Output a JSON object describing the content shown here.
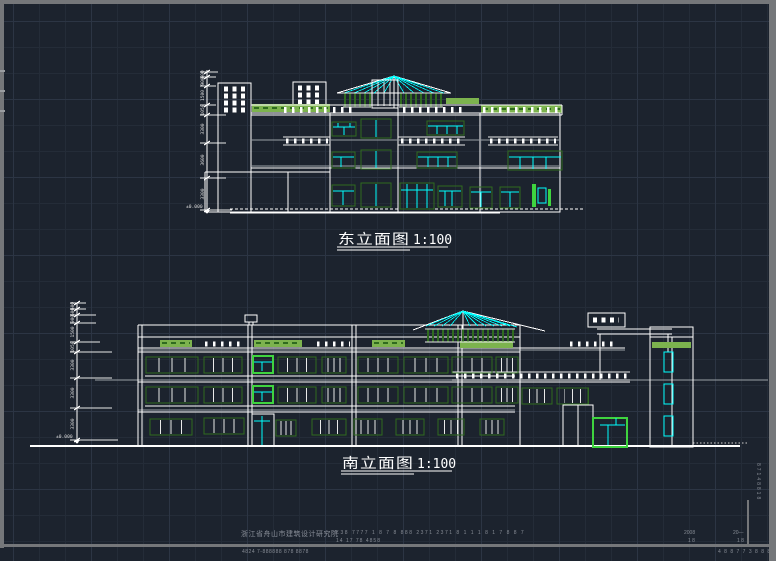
{
  "canvas": {
    "background": "#1c232e",
    "grid_minor": "#242c38",
    "grid_major": "#2c3544",
    "frame_color": "#75777a"
  },
  "palette": {
    "line_white": "#ffffff",
    "cyan": "#00ffff",
    "green_light": "#7cb34e",
    "green_dark": "#2f6b1f",
    "green_bright": "#3fd43f",
    "gray_line": "#9aa0a6",
    "faint_text": "#868b94"
  },
  "east_elevation": {
    "title": "东立面图",
    "scale": "1:100",
    "datum": "±0.000",
    "dims": [
      "600",
      "900",
      "1500",
      "1050",
      "3300",
      "3600",
      "3300"
    ]
  },
  "south_elevation": {
    "title": "南立面图",
    "scale": "1:100",
    "datum": "±0.000",
    "dims": [
      "600",
      "600",
      "900",
      "1500",
      "1050",
      "3300",
      "3300",
      "3300"
    ]
  },
  "title_block": {
    "company": "浙江省舟山市建筑设计研究院",
    "numbers_row1": "工38 7777  1  8  7  8  888  2371  2371  8  1  1  1  8  1  7  8  8  7",
    "numbers_row2": "14 17 78 4858",
    "bottom_note": "4824 7-888888 878 8878",
    "sheet_year": "2008",
    "sheet_no": "1 8",
    "date_label": "20—",
    "date_no": "1 8",
    "side_vertical": "87148818",
    "corner_marks": "4 8 8 7 7 3 8 8 8"
  }
}
